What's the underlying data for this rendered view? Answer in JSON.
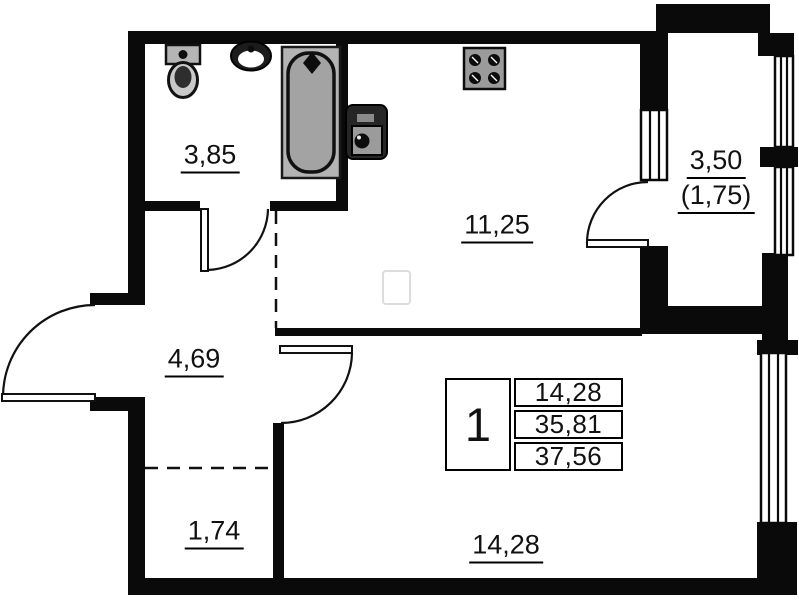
{
  "plan_title": "1-room apartment floor plan",
  "rooms": {
    "bathroom": {
      "area": "3,85"
    },
    "kitchen": {
      "area": "11,25"
    },
    "balcony": {
      "area": "3,50",
      "area_reduced": "(1,75)"
    },
    "hallway": {
      "area": "4,69"
    },
    "closet": {
      "area": "1,74"
    },
    "living_room": {
      "area": "14,28"
    }
  },
  "info_table": {
    "rooms_count": "1",
    "living_area": "14,28",
    "apartment_area": "35,81",
    "total_area": "37,56"
  },
  "colors": {
    "wall": "#0a0a0a",
    "fixture_gray": "#a8a8a8",
    "background": "#ffffff"
  }
}
